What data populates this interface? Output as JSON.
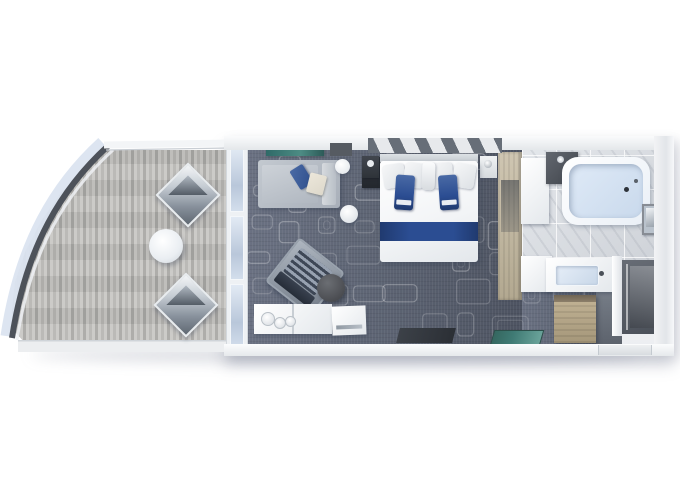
{
  "scene": {
    "title": "Stateroom floor plan 3D render",
    "type": "top-down 3D rendering of a ship suite with balcony, no visible text",
    "rooms": [
      {
        "name": "balcony",
        "furniture": [
          "lounge chair",
          "lounge chair",
          "round cocktail table",
          "curved glass railing",
          "wood deck"
        ]
      },
      {
        "name": "living-area",
        "furniture": [
          "sofa with cushions",
          "wall shelf",
          "wall panel",
          "armchair",
          "round ottoman",
          "console with glasses",
          "side table",
          "round wall lamp"
        ]
      },
      {
        "name": "bedroom",
        "furniture": [
          "double bed with blue runner",
          "blue accent pillows",
          "nightstand",
          "nightstand",
          "slatted accent wall",
          "wardrobe",
          "desk"
        ]
      },
      {
        "name": "bathroom",
        "furniture": [
          "bathtub",
          "vanity with sink",
          "dark cabinet",
          "framed picture",
          "shower room"
        ]
      },
      {
        "name": "entry",
        "furniture": [
          "wood closet",
          "teal doormat",
          "dark floor mat",
          "entrance door"
        ]
      }
    ]
  },
  "labels": {
    "balcony": "Balcony",
    "deck": "Balcony wood deck",
    "railing": "Curved glass railing",
    "lounge_chair": "Lounge chair",
    "balcony_table": "Round cocktail table",
    "sliding_door": "Balcony sliding glass door",
    "carpet": "Living / bedroom carpet",
    "sofa": "Sofa",
    "armchair": "Armchair",
    "ottoman": "Round ottoman",
    "console": "Console with glassware",
    "coffee_table": "Side table",
    "wall_lamp": "Round wall lamp",
    "side_table": "Round side table",
    "tv_panel": "Wall panel",
    "shelf": "Wall shelf",
    "bed": "Double bed",
    "runner": "Blue bed runner",
    "pillow": "Pillow",
    "blue_throw": "Blue accent pillow",
    "nightstand": "Nightstand",
    "accent_wall": "Slatted accent wall",
    "wardrobe": "Wardrobe",
    "desk": "Desk / dresser",
    "bathroom_floor": "Marble bathroom floor",
    "bathtub": "Bathtub",
    "vanity": "Vanity with sink",
    "cabinet": "Bathroom cabinet",
    "picture": "Framed picture",
    "shower": "Shower room",
    "entry_floor": "Entry hallway",
    "closet": "Entry wood closet",
    "teal_mat": "Teal doormat",
    "dark_mat": "Floor mat",
    "door": "Entrance door"
  },
  "colors": {
    "bg": "#ffffff",
    "deck1": "#c9c8c5",
    "deck2": "#b7b6b3",
    "deck3": "#a9a8a5",
    "rail": "#4d525a",
    "glass": "#dbe4f0",
    "carpet1": "#6a7182",
    "carpet2": "#5b6271",
    "carpet3": "#4d5361",
    "blue1": "#2b4d92",
    "blue2": "#4a6aa5",
    "blue3": "#203a6f",
    "sofa1": "#c3c9d0",
    "sofa2": "#a8afb9",
    "cream": "#ddd8cb",
    "teal": "#3f7a74",
    "wood1": "#c3b496",
    "wood2": "#a5977a",
    "wood3": "#cfc6b2",
    "wood4": "#b2a890",
    "darkroom": "#565c66",
    "tub_water": "#dfeaf7",
    "marble": "#d8dbdf",
    "pattern_line": "#ffffff"
  }
}
